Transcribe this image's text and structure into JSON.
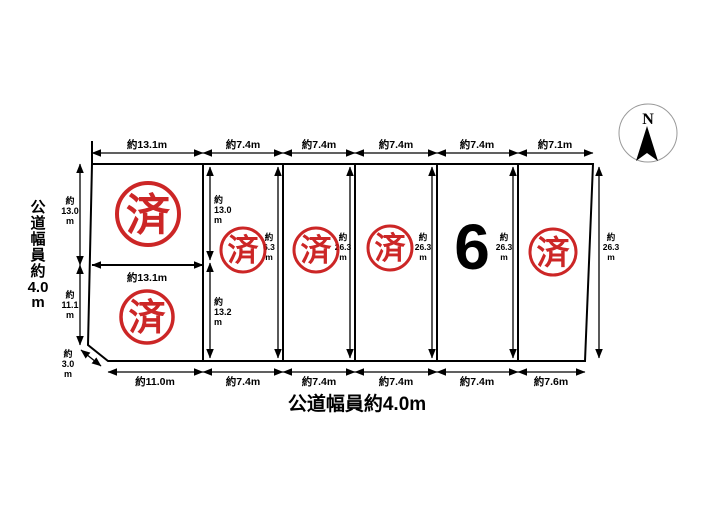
{
  "diagram": {
    "compass_label": "N",
    "road_left_lines": [
      "公",
      "道",
      "幅",
      "員",
      "約",
      "4.0",
      "m"
    ],
    "road_bottom_label": "公道幅員約4.0m",
    "dims_top": [
      "約13.1m",
      "約7.4m",
      "約7.4m",
      "約7.4m",
      "約7.4m",
      "約7.1m"
    ],
    "dims_bottom": [
      "約11.0m",
      "約7.4m",
      "約7.4m",
      "約7.4m",
      "約7.4m",
      "約7.6m"
    ],
    "dims_left": [
      [
        "約",
        "13.0",
        "m"
      ],
      [
        "約",
        "11.1",
        "m"
      ]
    ],
    "dim_corner": [
      "約",
      "3.0",
      "m"
    ],
    "dims_col2": [
      [
        "約",
        "13.0",
        "m"
      ],
      [
        "約",
        "13.2",
        "m"
      ]
    ],
    "dim_mid_width": "約13.1m",
    "dims_depth": [
      [
        "約",
        "6.3",
        "m"
      ],
      [
        "約",
        "26.3",
        "m"
      ],
      [
        "約",
        "26.3",
        "m"
      ],
      [
        "約",
        "26.3",
        "m"
      ],
      [
        "約",
        "26.3",
        "m"
      ]
    ],
    "stamp_text": "済",
    "lot_number": "6"
  },
  "colors": {
    "stamp_red": "#c81414",
    "line_black": "#000000",
    "compass_ring": "#999999"
  }
}
